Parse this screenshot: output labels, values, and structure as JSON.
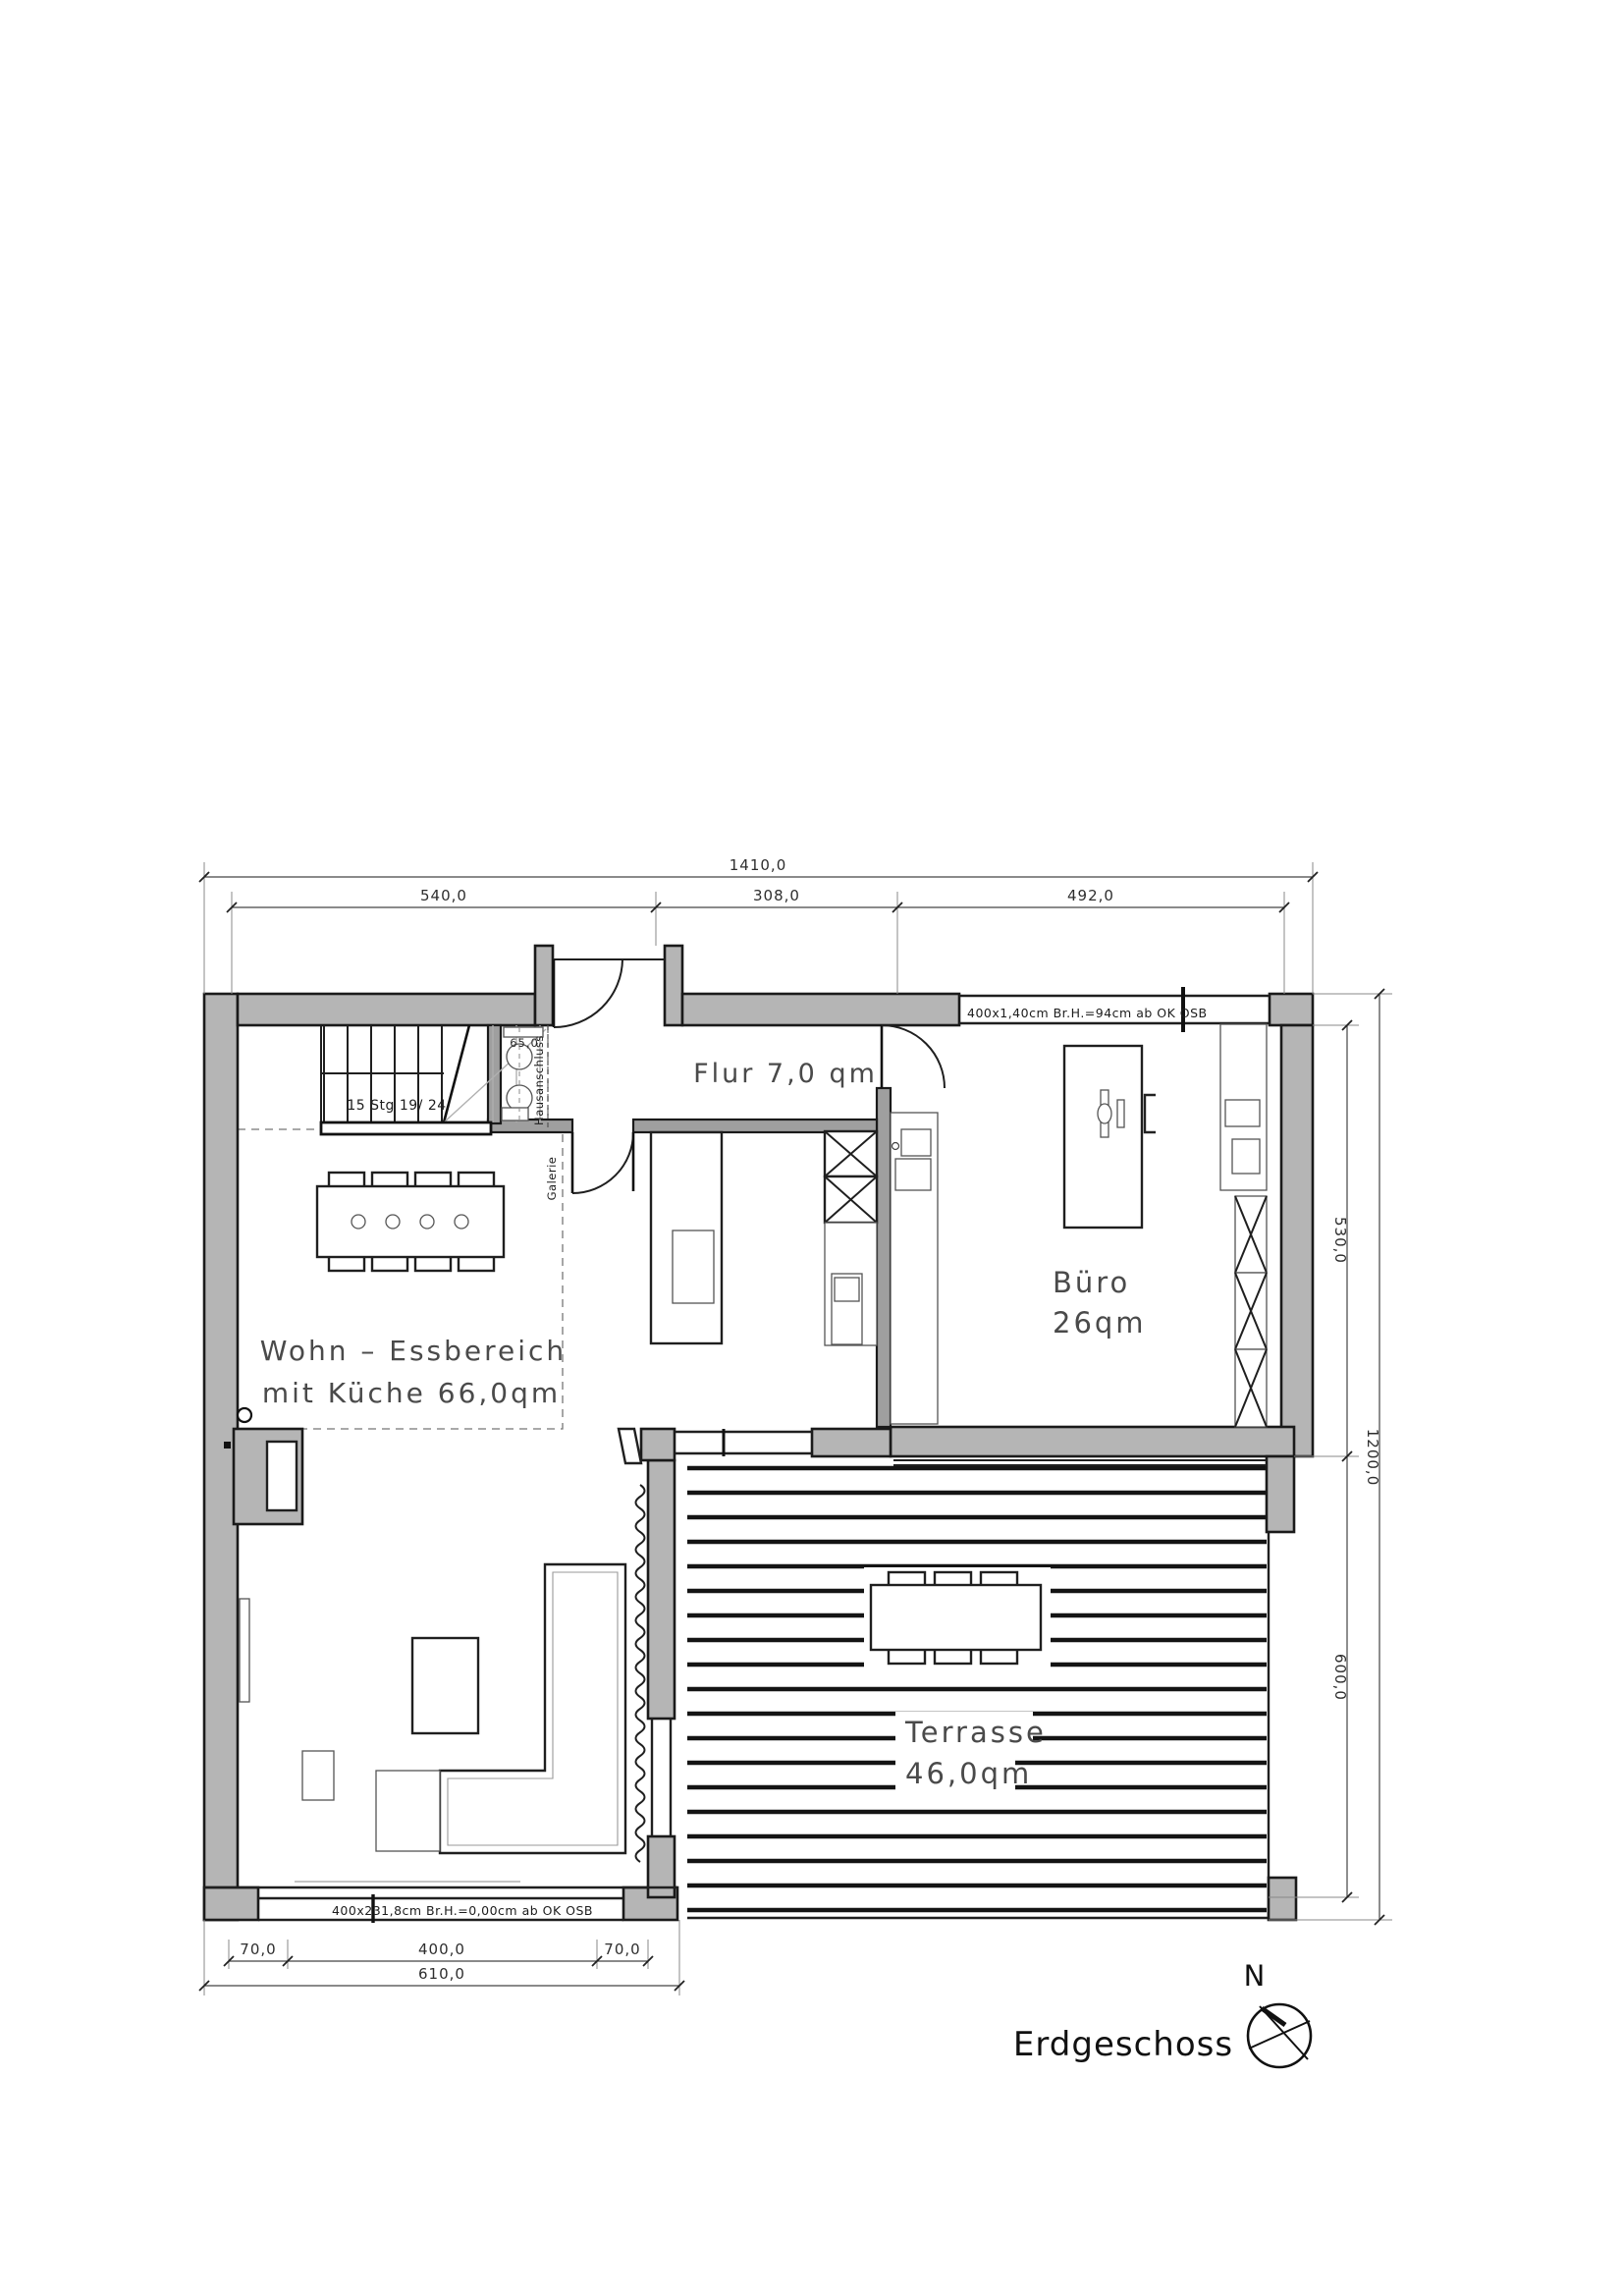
{
  "plan": {
    "title": "Erdgeschoss",
    "north_label": "N",
    "rooms": {
      "flur": {
        "label": "Flur 7,0 qm"
      },
      "buero": {
        "name": "Büro",
        "area": "26qm"
      },
      "wohn": {
        "line1": "Wohn – Essbereich",
        "line2": "mit Küche 66,0qm"
      },
      "terrasse": {
        "name": "Terrasse",
        "area": "46,0qm"
      }
    },
    "stairs": {
      "label": "15 Stg 19/ 24"
    },
    "hausanschluss": {
      "label": "Hausanschluss",
      "dim": "65,0"
    },
    "galerie": {
      "label": "Galerie"
    },
    "windows": {
      "top": "400x1,40cm Br.H.=94cm ab OK OSB",
      "bottom": "400x231,8cm Br.H.=0,00cm ab OK OSB"
    },
    "dimensions": {
      "top_total": "1410,0",
      "top_segments": [
        "540,0",
        "308,0",
        "492,0"
      ],
      "right_total": "1200,0",
      "right_segments": [
        "530,0",
        "600,0"
      ],
      "bottom_segments": [
        "70,0",
        "400,0",
        "70,0"
      ],
      "bottom_total": "610,0"
    },
    "colors": {
      "wall_fill": "#b5b5b5",
      "line": "#1a1a1a",
      "dim_text": "#2e2e2e"
    }
  }
}
